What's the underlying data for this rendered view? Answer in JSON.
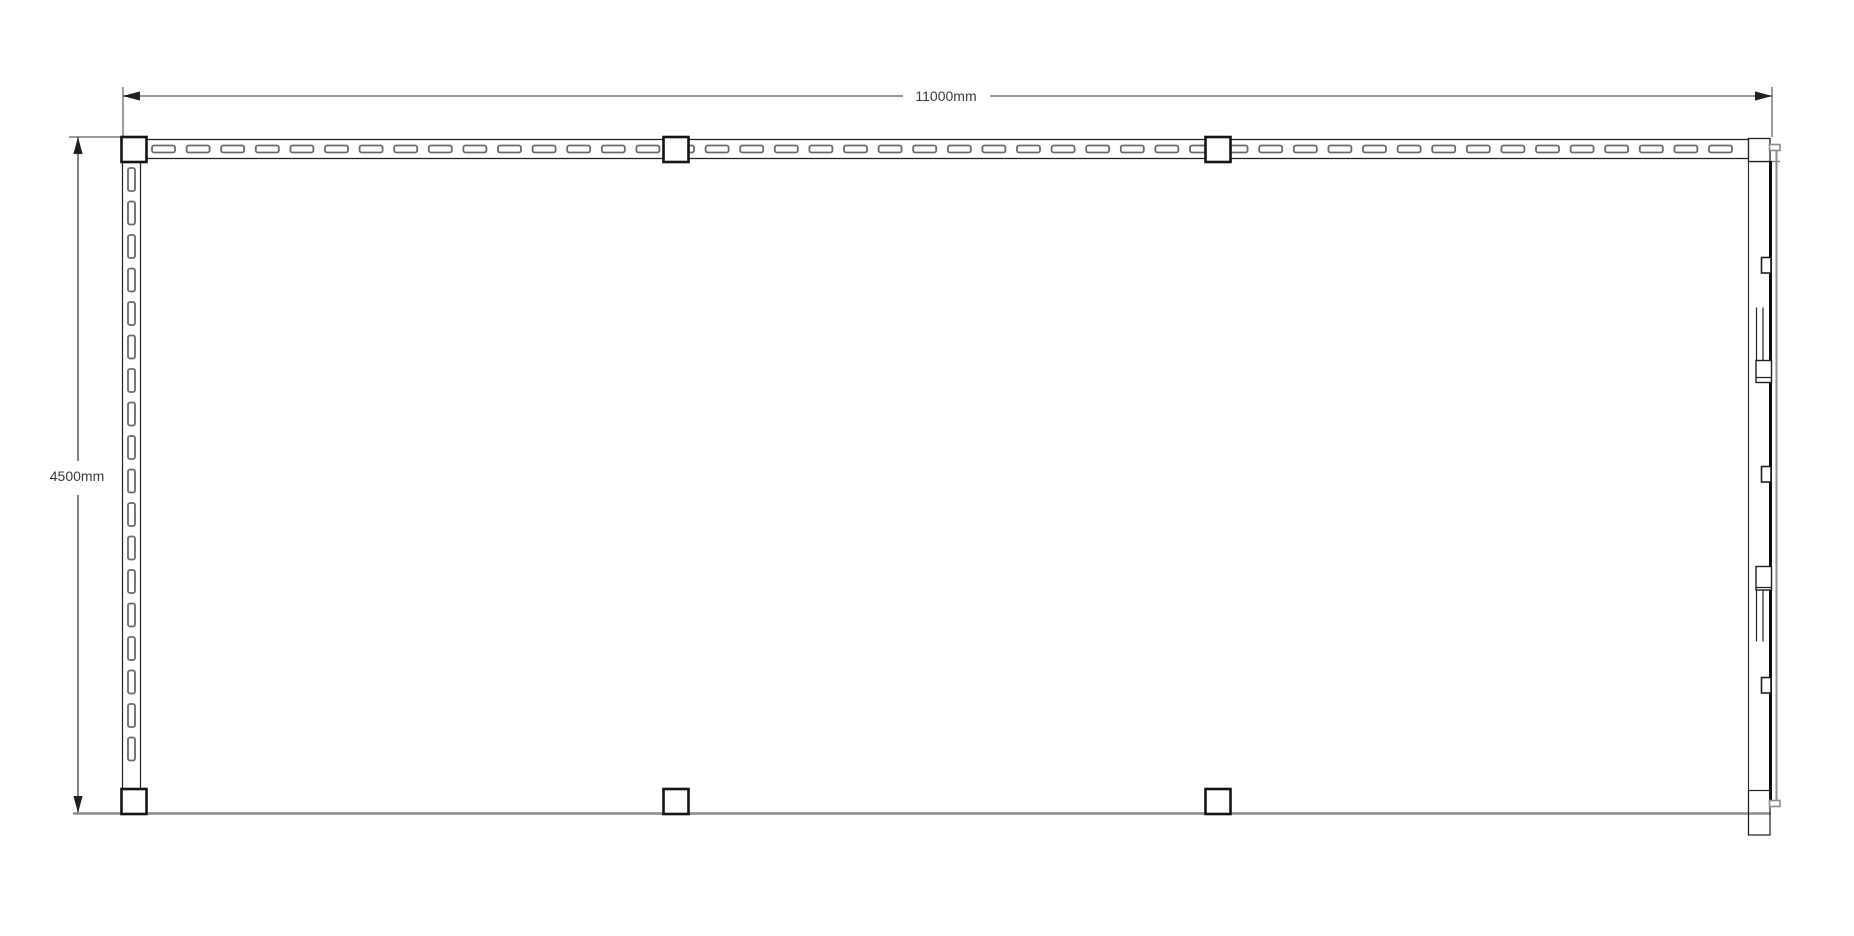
{
  "document": {
    "type": "floor-plan-technical-drawing",
    "background": "#ffffff"
  },
  "dimensions": {
    "width": {
      "label": "11000mm"
    },
    "height": {
      "label": "4500mm"
    }
  },
  "palette": {
    "ink": "#1f1f1f",
    "post": "#141414",
    "dash": "#6a6a6a",
    "gray": "#8c8c8c",
    "dim_line_h": "#969696",
    "dim_line_v": "#4a4a4a",
    "ext": "#3a3a3a",
    "text": "#3a3a3a",
    "track": "#0d0d0d",
    "bg": "#ffffff"
  },
  "geometry": {
    "canvas": {
      "w": 1854,
      "h": 936
    },
    "dim_width": {
      "y": 96,
      "x1": 123,
      "x2": 1772,
      "gap": [
        903,
        990
      ],
      "label_x": 946,
      "label_y": 101,
      "ext": [
        {
          "x": 123,
          "y1": 87,
          "y2": 136
        },
        {
          "x": 1772,
          "y1": 87,
          "y2": 137
        }
      ]
    },
    "dim_height": {
      "x": 78,
      "y1": 137,
      "y2": 813,
      "gap": [
        461,
        495
      ],
      "label_x": 77,
      "label_y": 481,
      "ext": {
        "y": 137,
        "x1": 69,
        "x2": 121
      }
    },
    "arrow": {
      "len": 17,
      "half_w": 4.6
    },
    "top_wall": {
      "x1": 147,
      "x2": 1748,
      "y1": 139.5,
      "y2": 158.5,
      "dash": {
        "start": 152,
        "len": 23,
        "h": 7,
        "cy": 149,
        "period": 34.6
      }
    },
    "left_wall": {
      "y1": 162,
      "y2": 789,
      "x1": 122.5,
      "x2": 140.5,
      "dash": {
        "start": 168,
        "len": 23,
        "w": 7,
        "cx": 131.5,
        "period": 33.5
      }
    },
    "bottom_edge": {
      "y": 813.5,
      "x1": 73,
      "x2": 1771
    },
    "posts": {
      "size": 25,
      "rows": [
        {
          "y": 137,
          "x": [
            121.5,
            663.5,
            1205.5
          ]
        },
        {
          "y": 789,
          "x": [
            121.5,
            663.5,
            1205.5
          ]
        }
      ]
    },
    "sliding_door": {
      "frame_x": 1748.5,
      "frame_y1": 138,
      "frame_y2": 835,
      "top_box": {
        "x": 1748.5,
        "y": 138.5,
        "w": 21.5,
        "h": 23
      },
      "bottom_box": {
        "x": 1748.5,
        "y": 790.5,
        "w": 21.5,
        "h": 44.5
      },
      "top_rail_gray": {
        "y": 161.5,
        "x1": 1748,
        "x2": 1780
      },
      "track_black": {
        "x": 1770.5,
        "y1": 161,
        "y2": 800
      },
      "track_gray": {
        "x": 1776.5,
        "y1": 147,
        "y2": 805
      },
      "tabs": [
        {
          "x": 1769.5,
          "y": 144.5,
          "w": 10.5,
          "h": 6
        },
        {
          "x": 1769.5,
          "y": 800.5,
          "w": 10.5,
          "h": 6
        }
      ],
      "rollers": {
        "x": 1761.5,
        "w": 9.5,
        "h": 15.5,
        "ys": [
          257.5,
          466.5,
          677.5
        ]
      },
      "handle_lines_x": [
        1756.5,
        1763
      ],
      "handle_box_x": 1756,
      "handle_box_w": 15.5,
      "handles": [
        {
          "line_y1": 307.5,
          "line_y2": 382.5,
          "box_y": 360.5,
          "box_h": 22,
          "divider_y": 377.5
        },
        {
          "line_y1": 567.5,
          "line_y2": 641.5,
          "box_y": 566.5,
          "box_h": 23.5,
          "divider_y": 587.5
        }
      ]
    }
  }
}
